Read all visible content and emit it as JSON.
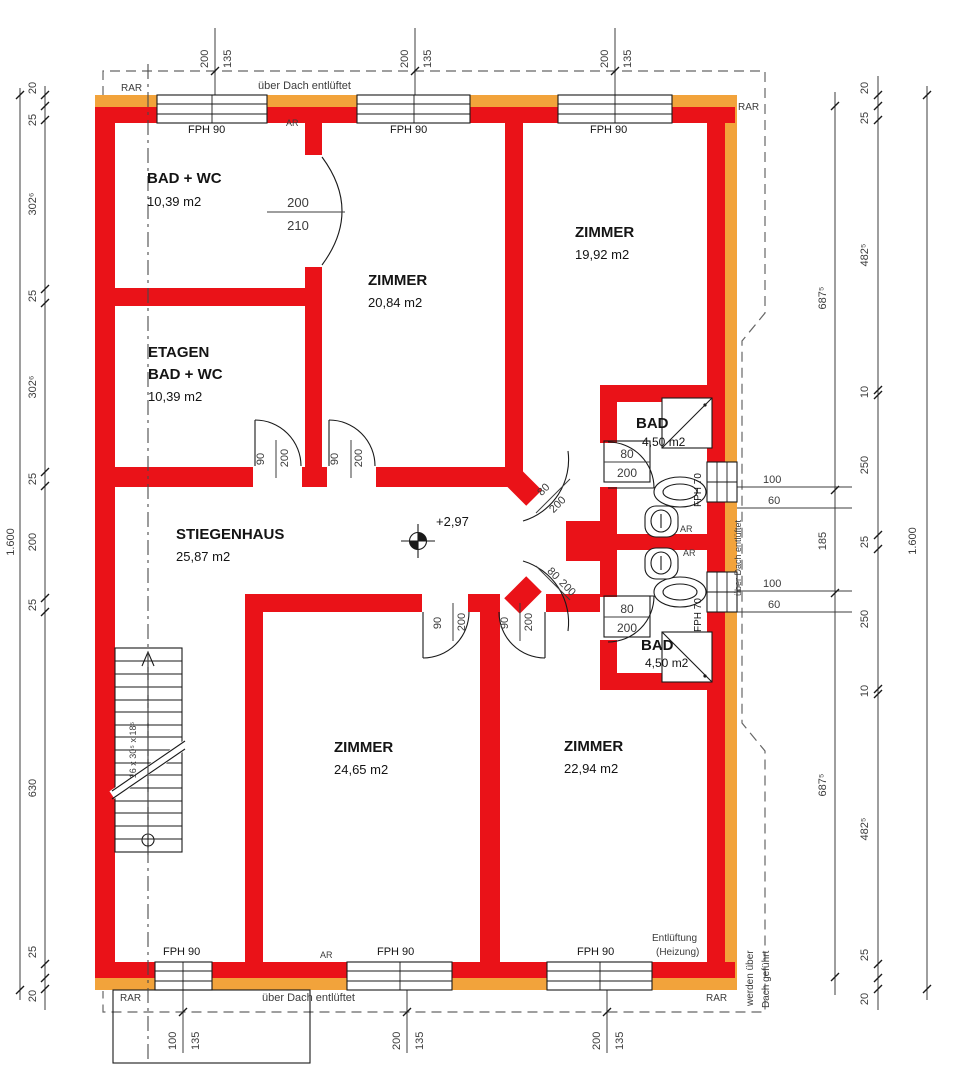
{
  "colors": {
    "wall": "#ea1218",
    "insulation": "#f2a33b",
    "linework": "#1a1a1a",
    "dim": "#3c3c3c",
    "dashed": "#666666"
  },
  "texts": [
    {
      "name": "room-badwc-name",
      "text": "BAD + WC",
      "x": 147,
      "y": 183,
      "size": 15,
      "bold": true
    },
    {
      "name": "room-badwc-area",
      "text": "10,39 m2",
      "x": 147,
      "y": 206,
      "size": 13
    },
    {
      "name": "room-etagen-name-line1",
      "text": "ETAGEN",
      "x": 148,
      "y": 357,
      "size": 15,
      "bold": true
    },
    {
      "name": "room-etagen-name-line2",
      "text": "BAD + WC",
      "x": 148,
      "y": 379,
      "size": 15,
      "bold": true
    },
    {
      "name": "room-etagen-area",
      "text": "10,39 m2",
      "x": 148,
      "y": 401,
      "size": 13
    },
    {
      "name": "room-zimmer1-name",
      "text": "ZIMMER",
      "x": 368,
      "y": 285,
      "size": 15,
      "bold": true
    },
    {
      "name": "room-zimmer1-area",
      "text": "20,84 m2",
      "x": 368,
      "y": 307,
      "size": 13
    },
    {
      "name": "room-zimmer2-name",
      "text": "ZIMMER",
      "x": 575,
      "y": 237,
      "size": 15,
      "bold": true
    },
    {
      "name": "room-zimmer2-area",
      "text": "19,92 m2",
      "x": 575,
      "y": 259,
      "size": 13
    },
    {
      "name": "room-stiegenhaus-name",
      "text": "STIEGENHAUS",
      "x": 176,
      "y": 539,
      "size": 15,
      "bold": true
    },
    {
      "name": "room-stiegenhaus-area",
      "text": "25,87 m2",
      "x": 176,
      "y": 561,
      "size": 13
    },
    {
      "name": "room-zimmer3-name",
      "text": "ZIMMER",
      "x": 334,
      "y": 752,
      "size": 15,
      "bold": true
    },
    {
      "name": "room-zimmer3-area",
      "text": "24,65 m2",
      "x": 334,
      "y": 774,
      "size": 13
    },
    {
      "name": "room-zimmer4-name",
      "text": "ZIMMER",
      "x": 564,
      "y": 751,
      "size": 15,
      "bold": true
    },
    {
      "name": "room-zimmer4-area",
      "text": "22,94 m2",
      "x": 564,
      "y": 773,
      "size": 13
    },
    {
      "name": "room-bad1-name",
      "text": "BAD",
      "x": 636,
      "y": 428,
      "size": 15,
      "bold": true
    },
    {
      "name": "room-bad1-area",
      "text": "4,50 m2",
      "x": 642,
      "y": 446,
      "size": 12
    },
    {
      "name": "room-bad2-name",
      "text": "BAD",
      "x": 641,
      "y": 650,
      "size": 15,
      "bold": true
    },
    {
      "name": "room-bad2-area",
      "text": "4,50 m2",
      "x": 645,
      "y": 667,
      "size": 12
    },
    {
      "name": "level-value",
      "text": "+2,97",
      "x": 436,
      "y": 526,
      "size": 13
    },
    {
      "name": "window-label-fph90-top-1",
      "text": "FPH 90",
      "x": 188,
      "y": 133,
      "size": 11
    },
    {
      "name": "window-label-fph90-top-2",
      "text": "FPH 90",
      "x": 390,
      "y": 133,
      "size": 11
    },
    {
      "name": "window-label-fph90-top-3",
      "text": "FPH 90",
      "x": 590,
      "y": 133,
      "size": 11
    },
    {
      "name": "window-label-fph90-bottom-1",
      "text": "FPH 90",
      "x": 163,
      "y": 955,
      "size": 11
    },
    {
      "name": "window-label-fph90-bottom-2",
      "text": "FPH 90",
      "x": 377,
      "y": 955,
      "size": 11
    },
    {
      "name": "window-label-fph90-bottom-3",
      "text": "FPH 90",
      "x": 577,
      "y": 955,
      "size": 11
    },
    {
      "name": "window-label-fph70-top",
      "text": "FPH 70",
      "x": 701,
      "y": 507,
      "size": 10,
      "rot": -90
    },
    {
      "name": "window-label-fph70-bottom",
      "text": "FPH 70",
      "x": 701,
      "y": 632,
      "size": 10,
      "rot": -90
    },
    {
      "name": "vent-note-top",
      "text": "über Dach entlüftet",
      "x": 258,
      "y": 89,
      "size": 11,
      "cls": "dim"
    },
    {
      "name": "vent-note-bottom",
      "text": "über Dach entlüftet",
      "x": 262,
      "y": 1001,
      "size": 11,
      "cls": "dim"
    },
    {
      "name": "vent-note-right",
      "text": "über Dach entlüftet",
      "x": 741,
      "y": 596,
      "size": 9,
      "rot": -90,
      "cls": "dim"
    },
    {
      "name": "vent-note-heating-line1",
      "text": "Entlüftung",
      "x": 652,
      "y": 941,
      "size": 10,
      "cls": "dim"
    },
    {
      "name": "vent-note-heating-line2",
      "text": "(Heizung)",
      "x": 656,
      "y": 955,
      "size": 10,
      "cls": "dim"
    },
    {
      "name": "vent-note-roof-line1",
      "text": "werden über",
      "x": 753,
      "y": 1006,
      "size": 10,
      "rot": -90,
      "cls": "dim"
    },
    {
      "name": "vent-note-roof-line2",
      "text": "Dach geführt",
      "x": 769,
      "y": 1008,
      "size": 10,
      "rot": -90,
      "cls": "dim"
    },
    {
      "name": "label-rar-top-left",
      "text": "RAR",
      "x": 121,
      "y": 91,
      "size": 10,
      "cls": "dim"
    },
    {
      "name": "label-rar-top-right",
      "text": "RAR",
      "x": 738,
      "y": 110,
      "size": 10,
      "cls": "dim"
    },
    {
      "name": "label-rar-bottom-left",
      "text": "RAR",
      "x": 120,
      "y": 1001,
      "size": 10,
      "cls": "dim"
    },
    {
      "name": "label-rar-bottom-right",
      "text": "RAR",
      "x": 706,
      "y": 1001,
      "size": 10,
      "cls": "dim"
    },
    {
      "name": "label-ar-top",
      "text": "AR",
      "x": 286,
      "y": 126,
      "size": 9,
      "cls": "dim"
    },
    {
      "name": "label-ar-bottom",
      "text": "AR",
      "x": 320,
      "y": 958,
      "size": 9,
      "cls": "dim"
    },
    {
      "name": "label-ar-right-1",
      "text": "AR",
      "x": 680,
      "y": 532,
      "size": 9,
      "cls": "dim"
    },
    {
      "name": "label-ar-right-2",
      "text": "AR",
      "x": 683,
      "y": 556,
      "size": 9,
      "cls": "dim"
    },
    {
      "name": "dim-top-1-width",
      "text": "200",
      "x": 208,
      "y": 68,
      "rot": -90,
      "cls": "dim"
    },
    {
      "name": "dim-top-1-height",
      "text": "135",
      "x": 231,
      "y": 68,
      "rot": -90,
      "cls": "dim"
    },
    {
      "name": "dim-top-2-width",
      "text": "200",
      "x": 408,
      "y": 68,
      "rot": -90,
      "cls": "dim"
    },
    {
      "name": "dim-top-2-height",
      "text": "135",
      "x": 431,
      "y": 68,
      "rot": -90,
      "cls": "dim"
    },
    {
      "name": "dim-top-3-width",
      "text": "200",
      "x": 608,
      "y": 68,
      "rot": -90,
      "cls": "dim"
    },
    {
      "name": "dim-top-3-height",
      "text": "135",
      "x": 631,
      "y": 68,
      "rot": -90,
      "cls": "dim"
    },
    {
      "name": "dim-bottom-1-width",
      "text": "100",
      "x": 176,
      "y": 1050,
      "rot": -90,
      "cls": "dim"
    },
    {
      "name": "dim-bottom-1-height",
      "text": "135",
      "x": 199,
      "y": 1050,
      "rot": -90,
      "cls": "dim"
    },
    {
      "name": "dim-bottom-2-width",
      "text": "200",
      "x": 400,
      "y": 1050,
      "rot": -90,
      "cls": "dim"
    },
    {
      "name": "dim-bottom-2-height",
      "text": "135",
      "x": 423,
      "y": 1050,
      "rot": -90,
      "cls": "dim"
    },
    {
      "name": "dim-bottom-3-width",
      "text": "200",
      "x": 600,
      "y": 1050,
      "rot": -90,
      "cls": "dim"
    },
    {
      "name": "dim-bottom-3-height",
      "text": "135",
      "x": 623,
      "y": 1050,
      "rot": -90,
      "cls": "dim"
    },
    {
      "name": "dim-left-seg-1",
      "text": "20",
      "x": 36,
      "y": 88,
      "rot": -90,
      "anchor": "middle",
      "cls": "dim"
    },
    {
      "name": "dim-left-seg-2",
      "text": "25",
      "x": 36,
      "y": 120,
      "rot": -90,
      "anchor": "middle",
      "cls": "dim"
    },
    {
      "name": "dim-left-seg-3",
      "text": "302⁶",
      "x": 36,
      "y": 204,
      "rot": -90,
      "anchor": "middle",
      "cls": "dim"
    },
    {
      "name": "dim-left-seg-4",
      "text": "25",
      "x": 36,
      "y": 296,
      "rot": -90,
      "anchor": "middle",
      "cls": "dim"
    },
    {
      "name": "dim-left-seg-5",
      "text": "302⁶",
      "x": 36,
      "y": 387,
      "rot": -90,
      "anchor": "middle",
      "cls": "dim"
    },
    {
      "name": "dim-left-seg-6",
      "text": "25",
      "x": 36,
      "y": 479,
      "rot": -90,
      "anchor": "middle",
      "cls": "dim"
    },
    {
      "name": "dim-left-seg-7",
      "text": "200",
      "x": 36,
      "y": 542,
      "rot": -90,
      "anchor": "middle",
      "cls": "dim"
    },
    {
      "name": "dim-left-seg-8",
      "text": "25",
      "x": 36,
      "y": 605,
      "rot": -90,
      "anchor": "middle",
      "cls": "dim"
    },
    {
      "name": "dim-left-seg-9",
      "text": "630",
      "x": 36,
      "y": 788,
      "rot": -90,
      "anchor": "middle",
      "cls": "dim"
    },
    {
      "name": "dim-left-seg-10",
      "text": "25",
      "x": 36,
      "y": 952,
      "rot": -90,
      "anchor": "middle",
      "cls": "dim"
    },
    {
      "name": "dim-left-seg-11",
      "text": "20",
      "x": 36,
      "y": 996,
      "rot": -90,
      "anchor": "middle",
      "cls": "dim"
    },
    {
      "name": "dim-left-total",
      "text": "1.600",
      "x": 14,
      "y": 542,
      "rot": -90,
      "anchor": "middle",
      "cls": "dim"
    },
    {
      "name": "dim-right-seg-1",
      "text": "20",
      "x": 868,
      "y": 88,
      "rot": -90,
      "anchor": "middle",
      "cls": "dim"
    },
    {
      "name": "dim-right-seg-2",
      "text": "25",
      "x": 868,
      "y": 118,
      "rot": -90,
      "anchor": "middle",
      "cls": "dim"
    },
    {
      "name": "dim-right-seg-3",
      "text": "482⁵",
      "x": 868,
      "y": 255,
      "rot": -90,
      "anchor": "middle",
      "cls": "dim"
    },
    {
      "name": "dim-right-seg-4",
      "text": "10",
      "x": 868,
      "y": 392,
      "rot": -90,
      "anchor": "middle",
      "cls": "dim"
    },
    {
      "name": "dim-right-seg-5",
      "text": "250",
      "x": 868,
      "y": 465,
      "rot": -90,
      "anchor": "middle",
      "cls": "dim"
    },
    {
      "name": "dim-right-seg-6",
      "text": "25",
      "x": 868,
      "y": 542,
      "rot": -90,
      "anchor": "middle",
      "cls": "dim"
    },
    {
      "name": "dim-right-seg-7",
      "text": "250",
      "x": 868,
      "y": 619,
      "rot": -90,
      "anchor": "middle",
      "cls": "dim"
    },
    {
      "name": "dim-right-seg-8",
      "text": "10",
      "x": 868,
      "y": 691,
      "rot": -90,
      "anchor": "middle",
      "cls": "dim"
    },
    {
      "name": "dim-right-seg-9",
      "text": "482⁵",
      "x": 868,
      "y": 829,
      "rot": -90,
      "anchor": "middle",
      "cls": "dim"
    },
    {
      "name": "dim-right-seg-10",
      "text": "25",
      "x": 868,
      "y": 955,
      "rot": -90,
      "anchor": "middle",
      "cls": "dim"
    },
    {
      "name": "dim-right-seg-11",
      "text": "20",
      "x": 868,
      "y": 999,
      "rot": -90,
      "anchor": "middle",
      "cls": "dim"
    },
    {
      "name": "dim-right-mid-1",
      "text": "687⁵",
      "x": 826,
      "y": 298,
      "rot": -90,
      "anchor": "middle",
      "cls": "dim"
    },
    {
      "name": "dim-right-mid-2",
      "text": "185",
      "x": 826,
      "y": 541,
      "rot": -90,
      "anchor": "middle",
      "cls": "dim"
    },
    {
      "name": "dim-right-mid-3",
      "text": "687⁵",
      "x": 826,
      "y": 785,
      "rot": -90,
      "anchor": "middle",
      "cls": "dim"
    },
    {
      "name": "dim-right-total",
      "text": "1.600",
      "x": 916,
      "y": 541,
      "rot": -90,
      "anchor": "middle",
      "cls": "dim"
    },
    {
      "name": "dim-window-right-top-width",
      "text": "100",
      "x": 763,
      "y": 483,
      "cls": "dim"
    },
    {
      "name": "dim-window-right-top-parapet",
      "text": "60",
      "x": 768,
      "y": 504,
      "cls": "dim"
    },
    {
      "name": "dim-window-right-bottom-width",
      "text": "100",
      "x": 763,
      "y": 587,
      "cls": "dim"
    },
    {
      "name": "dim-window-right-bottom-parapet",
      "text": "60",
      "x": 768,
      "y": 608,
      "cls": "dim"
    },
    {
      "name": "door-dim-top-width",
      "text": "200",
      "x": 298,
      "y": 207,
      "size": 13,
      "anchor": "middle",
      "cls": "dim"
    },
    {
      "name": "door-dim-top-height",
      "text": "210",
      "x": 298,
      "y": 230,
      "size": 13,
      "anchor": "middle",
      "cls": "dim"
    },
    {
      "name": "door-dim-etagen-width",
      "text": "90",
      "x": 264,
      "y": 459,
      "rot": -90,
      "anchor": "middle",
      "cls": "dim"
    },
    {
      "name": "door-dim-etagen-height",
      "text": "200",
      "x": 288,
      "y": 458,
      "rot": -90,
      "anchor": "middle",
      "cls": "dim"
    },
    {
      "name": "door-dim-zimmer1-width",
      "text": "90",
      "x": 338,
      "y": 459,
      "rot": -90,
      "anchor": "middle",
      "cls": "dim"
    },
    {
      "name": "door-dim-zimmer1-height",
      "text": "200",
      "x": 362,
      "y": 458,
      "rot": -90,
      "anchor": "middle",
      "cls": "dim"
    },
    {
      "name": "door-dim-zimmer3-width",
      "text": "90",
      "x": 441,
      "y": 623,
      "rot": -90,
      "anchor": "middle",
      "cls": "dim"
    },
    {
      "name": "door-dim-zimmer3-height",
      "text": "200",
      "x": 465,
      "y": 622,
      "rot": -90,
      "anchor": "middle",
      "cls": "dim"
    },
    {
      "name": "door-dim-zimmer4-width",
      "text": "90",
      "x": 508,
      "y": 623,
      "rot": -90,
      "anchor": "middle",
      "cls": "dim"
    },
    {
      "name": "door-dim-zimmer4-height",
      "text": "200",
      "x": 532,
      "y": 622,
      "rot": -90,
      "anchor": "middle",
      "cls": "dim"
    },
    {
      "name": "door-dim-diag-top-width",
      "text": "80",
      "x": 546,
      "y": 492,
      "rot": -45,
      "anchor": "middle",
      "cls": "dim"
    },
    {
      "name": "door-dim-diag-top-height",
      "text": "200",
      "x": 560,
      "y": 507,
      "rot": -45,
      "anchor": "middle",
      "cls": "dim"
    },
    {
      "name": "door-dim-diag-bottom-width",
      "text": "80",
      "x": 551,
      "y": 576,
      "rot": 45,
      "anchor": "middle",
      "cls": "dim"
    },
    {
      "name": "door-dim-diag-bottom-height",
      "text": "200",
      "x": 565,
      "y": 590,
      "rot": 45,
      "anchor": "middle",
      "cls": "dim"
    },
    {
      "name": "door-dim-bad1-width",
      "text": "80",
      "x": 627,
      "y": 458,
      "size": 12,
      "anchor": "middle",
      "cls": "dim"
    },
    {
      "name": "door-dim-bad1-height",
      "text": "200",
      "x": 627,
      "y": 477,
      "size": 12,
      "anchor": "middle",
      "cls": "dim"
    },
    {
      "name": "door-dim-bad2-width",
      "text": "80",
      "x": 627,
      "y": 613,
      "size": 12,
      "anchor": "middle",
      "cls": "dim"
    },
    {
      "name": "door-dim-bad2-height",
      "text": "200",
      "x": 627,
      "y": 632,
      "size": 12,
      "anchor": "middle",
      "cls": "dim"
    },
    {
      "name": "stair-dim-note",
      "text": "16 x 30⁵ x 18⁵",
      "x": 136,
      "y": 750,
      "rot": -90,
      "anchor": "middle",
      "size": 9,
      "cls": "dim"
    }
  ]
}
